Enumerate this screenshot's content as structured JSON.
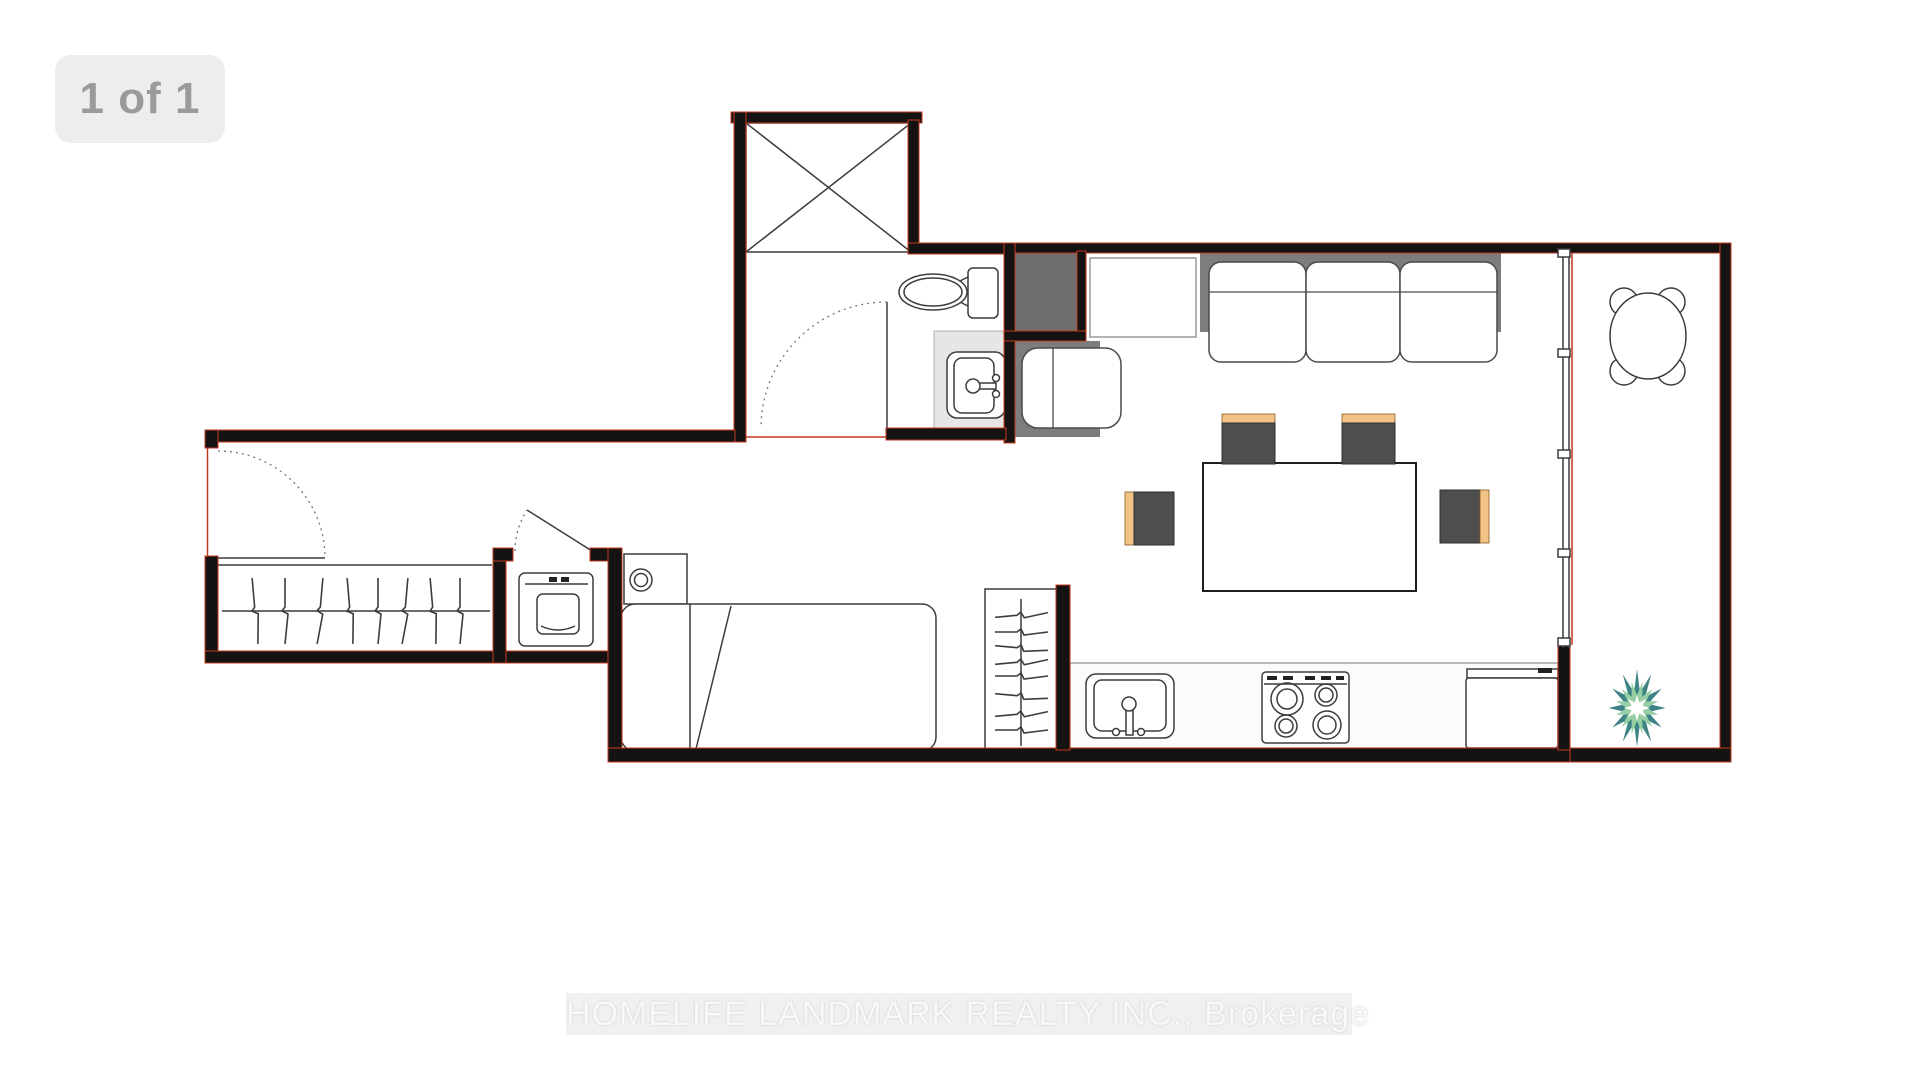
{
  "photo_viewer": {
    "counter_badge": "1 of 1",
    "watermark": "HOMELIFE LANDMARK REALTY INC., Brokerage"
  },
  "floor_plan": {
    "description": "studio condo floor plan, no room labels",
    "features": [
      "shaft-x-room",
      "bathroom",
      "toilet",
      "bathroom-sink",
      "bathroom-door",
      "entry-door",
      "hall-closet-with-hangers",
      "laundry-closet",
      "washer",
      "nightstand-with-lamp",
      "bed",
      "wardrobe-with-hangers",
      "kitchen-counter",
      "kitchen-sink",
      "stove",
      "fridge",
      "entry-closet",
      "tv-stand",
      "sofa",
      "armchair",
      "dining-table",
      "dining-stools",
      "window-wall",
      "balcony",
      "balcony-round-table",
      "balcony-plant"
    ]
  },
  "colors": {
    "wall": "#151311",
    "wall-accent": "#c2391f",
    "furniture-line": "#3c3c3c",
    "closet-fill": "#6e6e6e",
    "sofa-back": "#7d7d7d",
    "stool-dark": "#4e4e4e",
    "stool-accent": "#f2c387",
    "counter-light": "#e6e6e6",
    "plant-outer": "#3e8487",
    "plant-inner": "#97cfa4",
    "badge-bg": "#ededed",
    "badge-text": "#9a9a9a",
    "watermark-text": "#f8f8f8"
  }
}
